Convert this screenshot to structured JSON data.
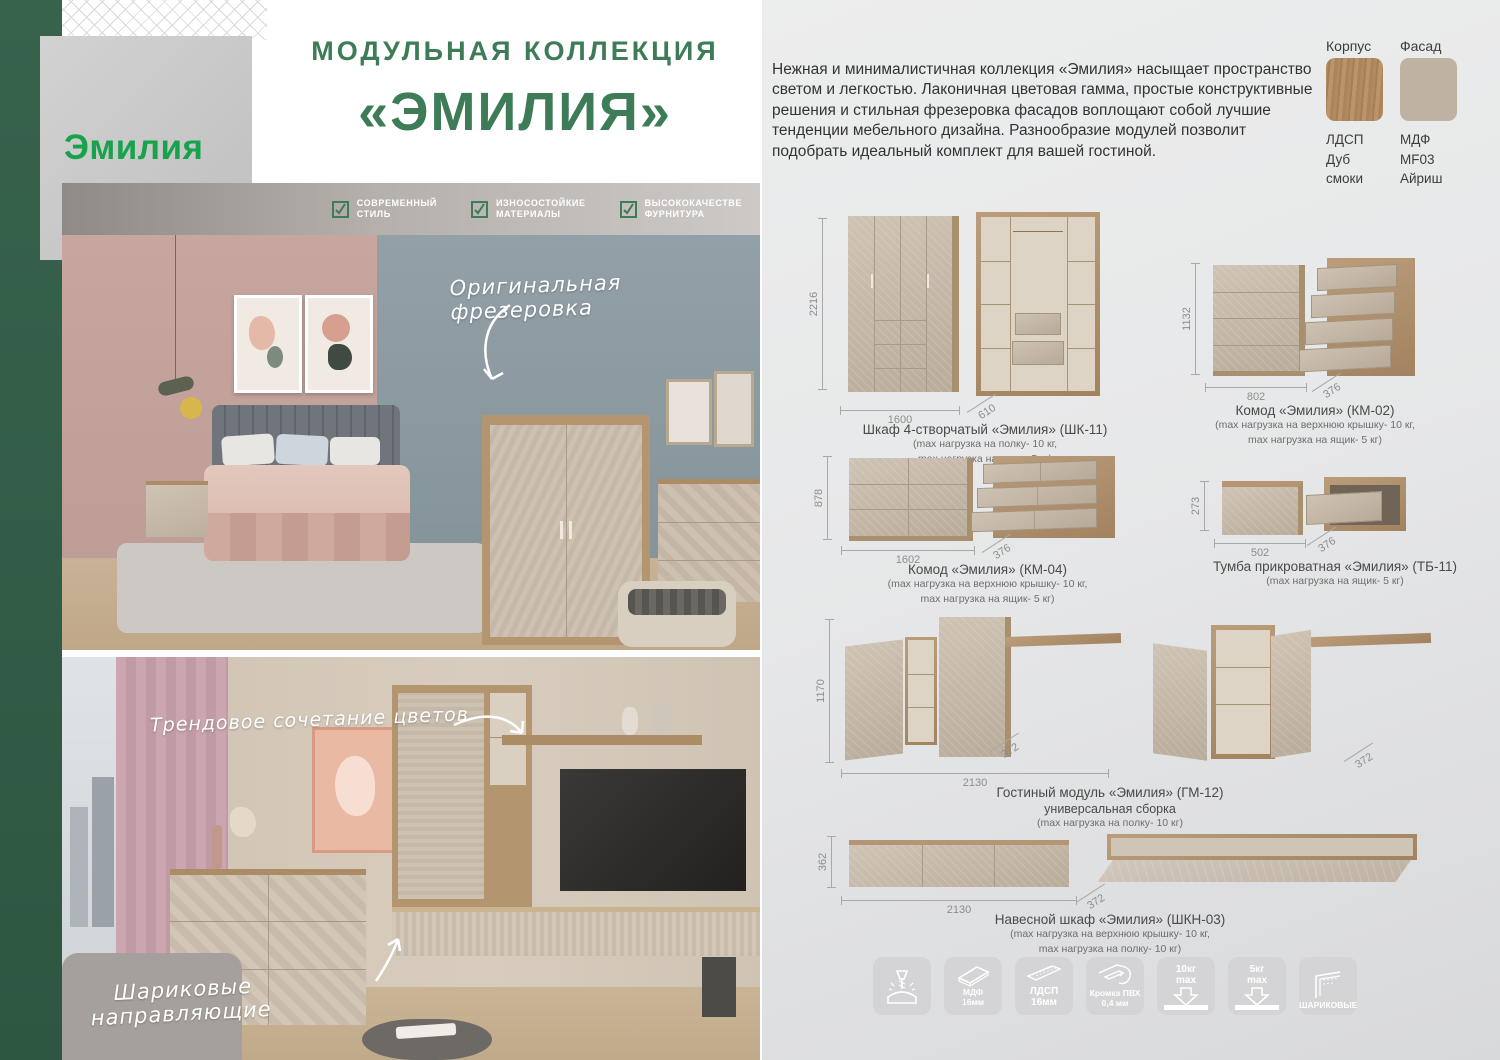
{
  "colors": {
    "accent_green": "#3d7c57",
    "logo_green": "#17a24c",
    "strip_green": "#33604a",
    "wood": "#ab8c66",
    "facade": "#c2b5a5"
  },
  "brand": {
    "logo": "Эмилия"
  },
  "header": {
    "title_line1": "МОДУЛЬНАЯ КОЛЛЕКЦИЯ",
    "title_line2": "«ЭМИЛИЯ»"
  },
  "badges": [
    {
      "line1": "СОВРЕМЕННЫЙ",
      "line2": "СТИЛЬ"
    },
    {
      "line1": "ИЗНОСОСТОЙКИЕ",
      "line2": "МАТЕРИАЛЫ"
    },
    {
      "line1": "ВЫСОКОКАЧЕСТВЕ",
      "line2": "ФУРНИТУРА"
    }
  ],
  "annotations": {
    "photo1": "Оригинальная фрезеровка",
    "photo2": "Трендовое сочетание цветов",
    "photo2b_line1": "Шариковые",
    "photo2b_line2": "направляющие"
  },
  "description": "Нежная и минималистичная коллекция «Эмилия» насыщает пространство светом и легкостью. Лаконичная цветовая гамма, простые конструктивные решения и стильная фрезеровка фасадов воплощают собой лучшие тенденции мебельного дизайна. Разнообразие модулей позволит подобрать идеальный комплект для вашей гостиной.",
  "materials": {
    "korpus_label": "Корпус",
    "fasad_label": "Фасад",
    "korpus_lines": [
      "ЛДСП",
      "Дуб",
      "смоки"
    ],
    "fasad_lines": [
      "МДФ",
      "MF03",
      "Айриш"
    ]
  },
  "products": [
    {
      "title": "Шкаф 4-створчатый «Эмилия» (ШК-11)",
      "note1": "(max нагрузка на полку- 10 кг,",
      "note2": "max нагрузка на ящик- 5 кг)",
      "dims": {
        "h": "2216",
        "w": "1600",
        "d": "610"
      }
    },
    {
      "title": "Комод «Эмилия» (КМ-02)",
      "note1": "(max нагрузка на верхнюю крышку- 10 кг,",
      "note2": "max нагрузка на ящик- 5 кг)",
      "dims": {
        "h": "1132",
        "w": "802",
        "d": "376"
      }
    },
    {
      "title": "Комод «Эмилия» (КМ-04)",
      "note1": "(max нагрузка на верхнюю крышку- 10 кг,",
      "note2": "max нагрузка на ящик- 5 кг)",
      "dims": {
        "h": "878",
        "w": "1602",
        "d": "376"
      }
    },
    {
      "title": "Тумба прикроватная «Эмилия» (ТБ-11)",
      "note1": "(max нагрузка на ящик- 5 кг)",
      "note2": "",
      "dims": {
        "h": "273",
        "w": "502",
        "d": "376"
      }
    },
    {
      "title": "Гостиный модуль «Эмилия» (ГМ-12)",
      "subtitle": "универсальная сборка",
      "note1": "(max нагрузка на полку- 10 кг)",
      "note2": "",
      "dims": {
        "h": "1170",
        "w": "2130",
        "d": "372"
      }
    },
    {
      "title": "Навесной шкаф «Эмилия» (ШКН-03)",
      "note1": "(max нагрузка на верхнюю крышку- 10 кг,",
      "note2": "max нагрузка на полку- 10 кг)",
      "dims": {
        "h": "362",
        "w": "2130",
        "d": "372"
      }
    }
  ],
  "feature_icons": [
    {
      "line1": "",
      "line2": ""
    },
    {
      "line1": "МДФ",
      "line2": "16мм"
    },
    {
      "line1": "ЛДСП",
      "line2": "16мм"
    },
    {
      "line1": "Кромка ПВХ",
      "line2": "0,4 мм"
    },
    {
      "line1": "10кг",
      "line2": "max"
    },
    {
      "line1": "5кг",
      "line2": "max"
    },
    {
      "line1": "ШАРИКОВЫЕ",
      "line2": ""
    }
  ]
}
